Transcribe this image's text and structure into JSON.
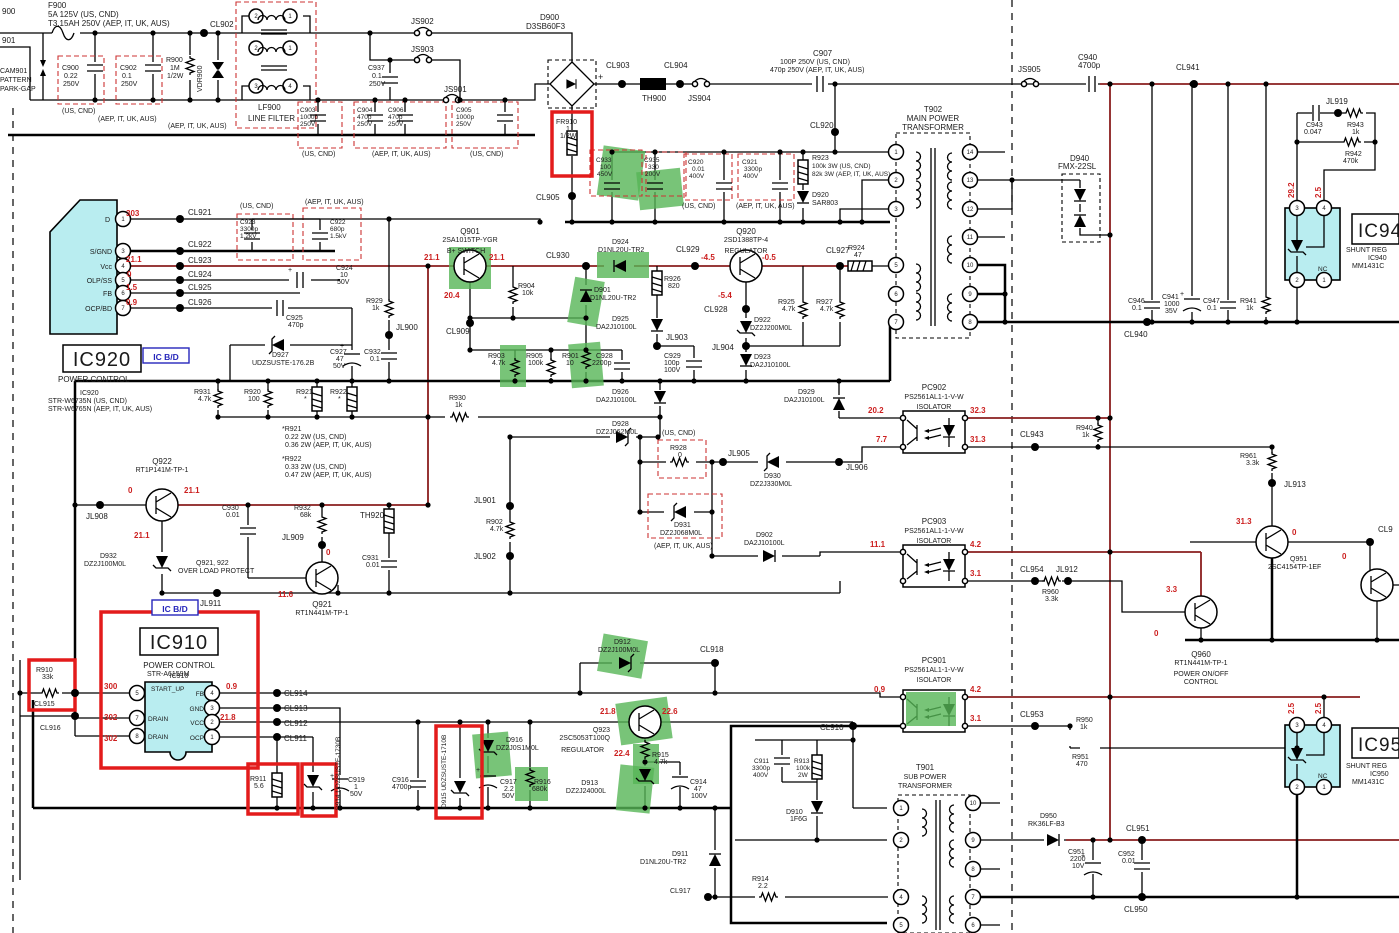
{
  "notes": {
    "us": "(US, CND)",
    "aep": "(AEP, IT, UK, AUS)",
    "plus": "+"
  },
  "pins": {
    "p1": "1",
    "p2": "2",
    "p3": "3",
    "p4": "4",
    "p5": "5",
    "p6": "6",
    "p7": "7",
    "p8": "8",
    "p9": "9",
    "p10": "10",
    "p11": "11",
    "p12": "12",
    "p13": "13",
    "p14": "14"
  },
  "parts": {
    "l900": "900",
    "l901": "901",
    "cam901": [
      "CAM901",
      "PATTERN",
      "PARK-GAP"
    ],
    "f900": [
      "F900",
      "5A 125V (US, CND)",
      "T3.15AH 250V (AEP, IT, UK, AUS)"
    ],
    "c900": [
      "C900",
      "0.22",
      "250V"
    ],
    "c902": [
      "C902",
      "0.1",
      "250V"
    ],
    "r900": [
      "R900",
      "1M",
      "1/2W"
    ],
    "vdr900": "VDR900",
    "cl902": "CL902",
    "lf900": [
      "LF900",
      "LINE FILTER"
    ],
    "js901": "JS901",
    "js902": "JS902",
    "js903": "JS903",
    "js904": "JS904",
    "js905": "JS905",
    "c937": [
      "C937",
      "0.1",
      "250V"
    ],
    "c903": [
      "C903",
      "1000p",
      "250V"
    ],
    "c904": [
      "C904",
      "470p",
      "250V"
    ],
    "c906": [
      "C906",
      "470p",
      "250V"
    ],
    "c905": [
      "C905",
      "1000p",
      "250V"
    ],
    "d900": [
      "D900",
      "D3SB60F3"
    ],
    "cl903": "CL903",
    "cl904": "CL904",
    "th900": "TH900",
    "c907": [
      "C907",
      "100P 250V (US, CND)",
      "470p 250V (AEP, IT, UK, AUS)"
    ],
    "fr910": [
      "FR910",
      "1",
      "1/2W"
    ],
    "cl905": "CL905",
    "c933": [
      "C933",
      "100",
      "450V"
    ],
    "c935": [
      "C935",
      "330",
      "200V"
    ],
    "c920": [
      "C920",
      "0.01",
      "400V"
    ],
    "c921": [
      "C921",
      "3300p",
      "400V"
    ],
    "r923": [
      "R923",
      "100k 3W (US, CND)",
      "82k 3W (AEP, IT, UK, AUS)"
    ],
    "d920": [
      "D920",
      "SAR803"
    ],
    "cl920": "CL920",
    "t902": [
      "T902",
      "MAIN POWER",
      "TRANSFORMER"
    ],
    "d940": [
      "D940",
      "FMX-22SL"
    ],
    "c940": [
      "C940",
      "4700p"
    ],
    "cl941": "CL941",
    "jl919": "JL919",
    "c943": [
      "C943",
      "0.047"
    ],
    "r943": [
      "R943",
      "1k"
    ],
    "r942": [
      "R942",
      "470k"
    ],
    "ic940box": "IC94",
    "ic940": [
      "SHUNT REG",
      "IC940",
      "MM1431C"
    ],
    "nc": "NC",
    "c946": [
      "C946",
      "0.1"
    ],
    "c941": [
      "C941",
      "1000",
      "35V"
    ],
    "c947": [
      "C947",
      "0.1"
    ],
    "r941": [
      "R941",
      "1k"
    ],
    "cl940": "CL940",
    "ic920": [
      "IC920",
      "POWER CONTROL",
      "IC920",
      "STR-W6735N (US, CND)",
      "STR-W6765N (AEP, IT, UK, AUS)"
    ],
    "icbd": "IC B/D",
    "pD": "D",
    "pSG": "S/GND",
    "pVcc": "Vcc",
    "pOLP": "OLP/SS",
    "pFB": "FB",
    "pOCP": "OCP/BD",
    "cl921": "CL921",
    "cl922": "CL922",
    "cl923": "CL923",
    "cl924": "CL924",
    "cl925": "CL925",
    "cl926": "CL926",
    "c923": [
      "C923",
      "3300p",
      "1.2kV"
    ],
    "c922": [
      "C922",
      "680p",
      "1.5kV"
    ],
    "c924": [
      "C924",
      "10",
      "50V"
    ],
    "c925": [
      "C925",
      "470p"
    ],
    "d927": [
      "D927",
      "UDZSUSTE-176.2B"
    ],
    "c927": [
      "C927",
      "47",
      "50V"
    ],
    "c932": [
      "C932",
      "0.1"
    ],
    "r929": [
      "R929",
      "1k"
    ],
    "jl900": "JL900",
    "r931": [
      "R931",
      "4.7k"
    ],
    "r920": [
      "R920",
      "100"
    ],
    "r921": [
      "R921",
      "*"
    ],
    "r922": [
      "R922",
      "*"
    ],
    "r921n": [
      "*R921",
      "0.22 2W (US, CND)",
      "0.36 2W (AEP, IT, UK, AUS)"
    ],
    "r922n": [
      "*R922",
      "0.33 2W (US, CND)",
      "0.47 2W (AEP, IT, UK, AUS)"
    ],
    "q922": [
      "Q922",
      "RT1P141M-TP-1"
    ],
    "jl908": "JL908",
    "d932": [
      "D932",
      "DZ2J100M0L"
    ],
    "olp": [
      "Q921, 922",
      "OVER LOAD PROTECT"
    ],
    "jl911": "JL911",
    "q921": [
      "Q921",
      "RT1N441M-TP-1"
    ],
    "c930": [
      "C930",
      "0.01"
    ],
    "r932": [
      "R932",
      "68k"
    ],
    "jl909": "JL909",
    "th920": "TH920",
    "c931": [
      "C931",
      "0.01"
    ],
    "r930": [
      "R930",
      "1k"
    ],
    "jl901": "JL901",
    "r902": [
      "R902",
      "4.7k"
    ],
    "jl902": "JL902",
    "q901": [
      "Q901",
      "2SA1015TP-YGR",
      "B+ SWITCH"
    ],
    "cl909": "CL909",
    "r904": [
      "R904",
      "10k"
    ],
    "cl930": "CL930",
    "d924": [
      "D924",
      "D1NL20U-TR2"
    ],
    "d901": [
      "D901",
      "D1NL20U-TR2"
    ],
    "d925": [
      "D925",
      "DA2J10100L"
    ],
    "jl903": "JL903",
    "r903": [
      "R903",
      "4.7k"
    ],
    "r905": [
      "R905",
      "100k"
    ],
    "r901": [
      "R901",
      "10"
    ],
    "c928": [
      "C928",
      "2200p"
    ],
    "c929": [
      "C929",
      "100p",
      "100V"
    ],
    "r926": [
      "R926",
      "820"
    ],
    "cl929": "CL929",
    "q920": [
      "Q920",
      "2SD1388TP-4",
      "REGULATOR"
    ],
    "cl928": "CL928",
    "jl904": "JL904",
    "d922": [
      "D922",
      "DZ2J200M0L"
    ],
    "d923": [
      "D923",
      "DA2J10100L"
    ],
    "r925": [
      "R925",
      "4.7k"
    ],
    "r927": [
      "R927",
      "4.7k"
    ],
    "cl927": "CL927",
    "r924": [
      "R924",
      "47"
    ],
    "d926": [
      "D926",
      "DA2J10100L"
    ],
    "d928": [
      "D928",
      "DZ2J062M0L"
    ],
    "r928": [
      "R928",
      "0"
    ],
    "jl905": "JL905",
    "d930": [
      "D930",
      "DZ2J330M0L"
    ],
    "jl906": "JL906",
    "d931": [
      "D931",
      "DZ2J068M0L"
    ],
    "d902": [
      "D902",
      "DA2J10100L"
    ],
    "d929": [
      "D929",
      "DA2J10100L"
    ],
    "pc902": [
      "PC902",
      "PS2561AL1-1-V-W",
      "ISOLATOR"
    ],
    "pc903": [
      "PC903",
      "PS2561AL1-1-V-W",
      "ISOLATOR"
    ],
    "pc901": [
      "PC901",
      "PS2561AL1-1-V-W",
      "ISOLATOR"
    ],
    "cl943": "CL943",
    "r940": [
      "R940",
      "1k"
    ],
    "r961": [
      "R961",
      "3.3k"
    ],
    "jl913": "JL913",
    "cl954": "CL954",
    "jl912": "JL912",
    "r960": [
      "R960",
      "3.3k"
    ],
    "q951": [
      "Q951",
      "2SC4154TP-1EF"
    ],
    "cl95x": "CL9",
    "q960": [
      "Q960",
      "RT1N441M-TP-1",
      "POWER ON/OFF",
      "CONTROL"
    ],
    "r910": [
      "R910",
      "33k"
    ],
    "cl915": "CL915",
    "cl916": "CL916",
    "ic910box": "IC910",
    "ic910": [
      "POWER CONTROL",
      "IC910",
      "STR-A6159M"
    ],
    "pSU": "START_UP",
    "pFB2": "FB",
    "pGND": "GND",
    "pVCC": "VCC",
    "pDRAIN": "DRAIN",
    "pOCP2": "OCP",
    "cl911": "CL911",
    "cl912": "CL912",
    "cl913": "CL913",
    "cl914": "CL914",
    "r911": [
      "R911",
      "5.6"
    ],
    "d914": "D914  UDZSUSTE-1730B",
    "d915": "D915  UDZSUSTE-1710B",
    "c919": [
      "C919",
      "1",
      "50V"
    ],
    "c916": [
      "C916",
      "4700p"
    ],
    "d916": [
      "D916",
      "DZ2J0S1M0L"
    ],
    "c917": [
      "C917",
      "2.2",
      "50V"
    ],
    "r916": [
      "R916",
      "680k"
    ],
    "q923": [
      "Q923",
      "2SC5053T100Q",
      "REGULATOR"
    ],
    "d913": [
      "D913",
      "DZ2J24000L"
    ],
    "r915": [
      "R915",
      "4.7k"
    ],
    "c914": [
      "C914",
      "47",
      "100V"
    ],
    "d912": [
      "D912",
      "DZ2J100M0L"
    ],
    "cl918": "CL918",
    "d911": [
      "D911",
      "D1NL20U-TR2"
    ],
    "r914": [
      "R914",
      "2.2"
    ],
    "cl917": "CL917",
    "c911": [
      "C911",
      "3300p",
      "400V"
    ],
    "r913": [
      "R913",
      "100k",
      "2W"
    ],
    "d910": [
      "D910",
      "1F6G"
    ],
    "cl910": "CL910",
    "t901": [
      "T901",
      "SUB POWER",
      "TRANSFORMER"
    ],
    "d950": [
      "D950",
      "RK36LF-B3"
    ],
    "cl951": "CL951",
    "c951": [
      "C951",
      "2200",
      "10V"
    ],
    "c952": [
      "C952",
      "0.01"
    ],
    "cl950": "CL950",
    "cl953": "CL953",
    "r950": [
      "R950",
      "1k"
    ],
    "r951": [
      "R951",
      "470"
    ],
    "ic950box": "IC95",
    "ic950": [
      "SHUNT REG",
      "IC950",
      "MM1431C"
    ]
  },
  "volt": {
    "v303": "303",
    "v211": "21.1",
    "v0": "0",
    "v15": "1.5",
    "v09": "0.9",
    "v204": "20.4",
    "vm45": "-4.5",
    "vm05": "-0.5",
    "vm54": "-5.4",
    "v116": "11.6",
    "v202": "20.2",
    "v77": "7.7",
    "v323": "32.3",
    "v313": "31.3",
    "v111": "11.1",
    "v42": "4.2",
    "v31": "3.1",
    "v300": "300",
    "v302": "302",
    "v218": "21.8",
    "v226": "22.6",
    "v224": "22.4",
    "v292": "29.2",
    "v25": "2.5",
    "v33": "3.3"
  }
}
